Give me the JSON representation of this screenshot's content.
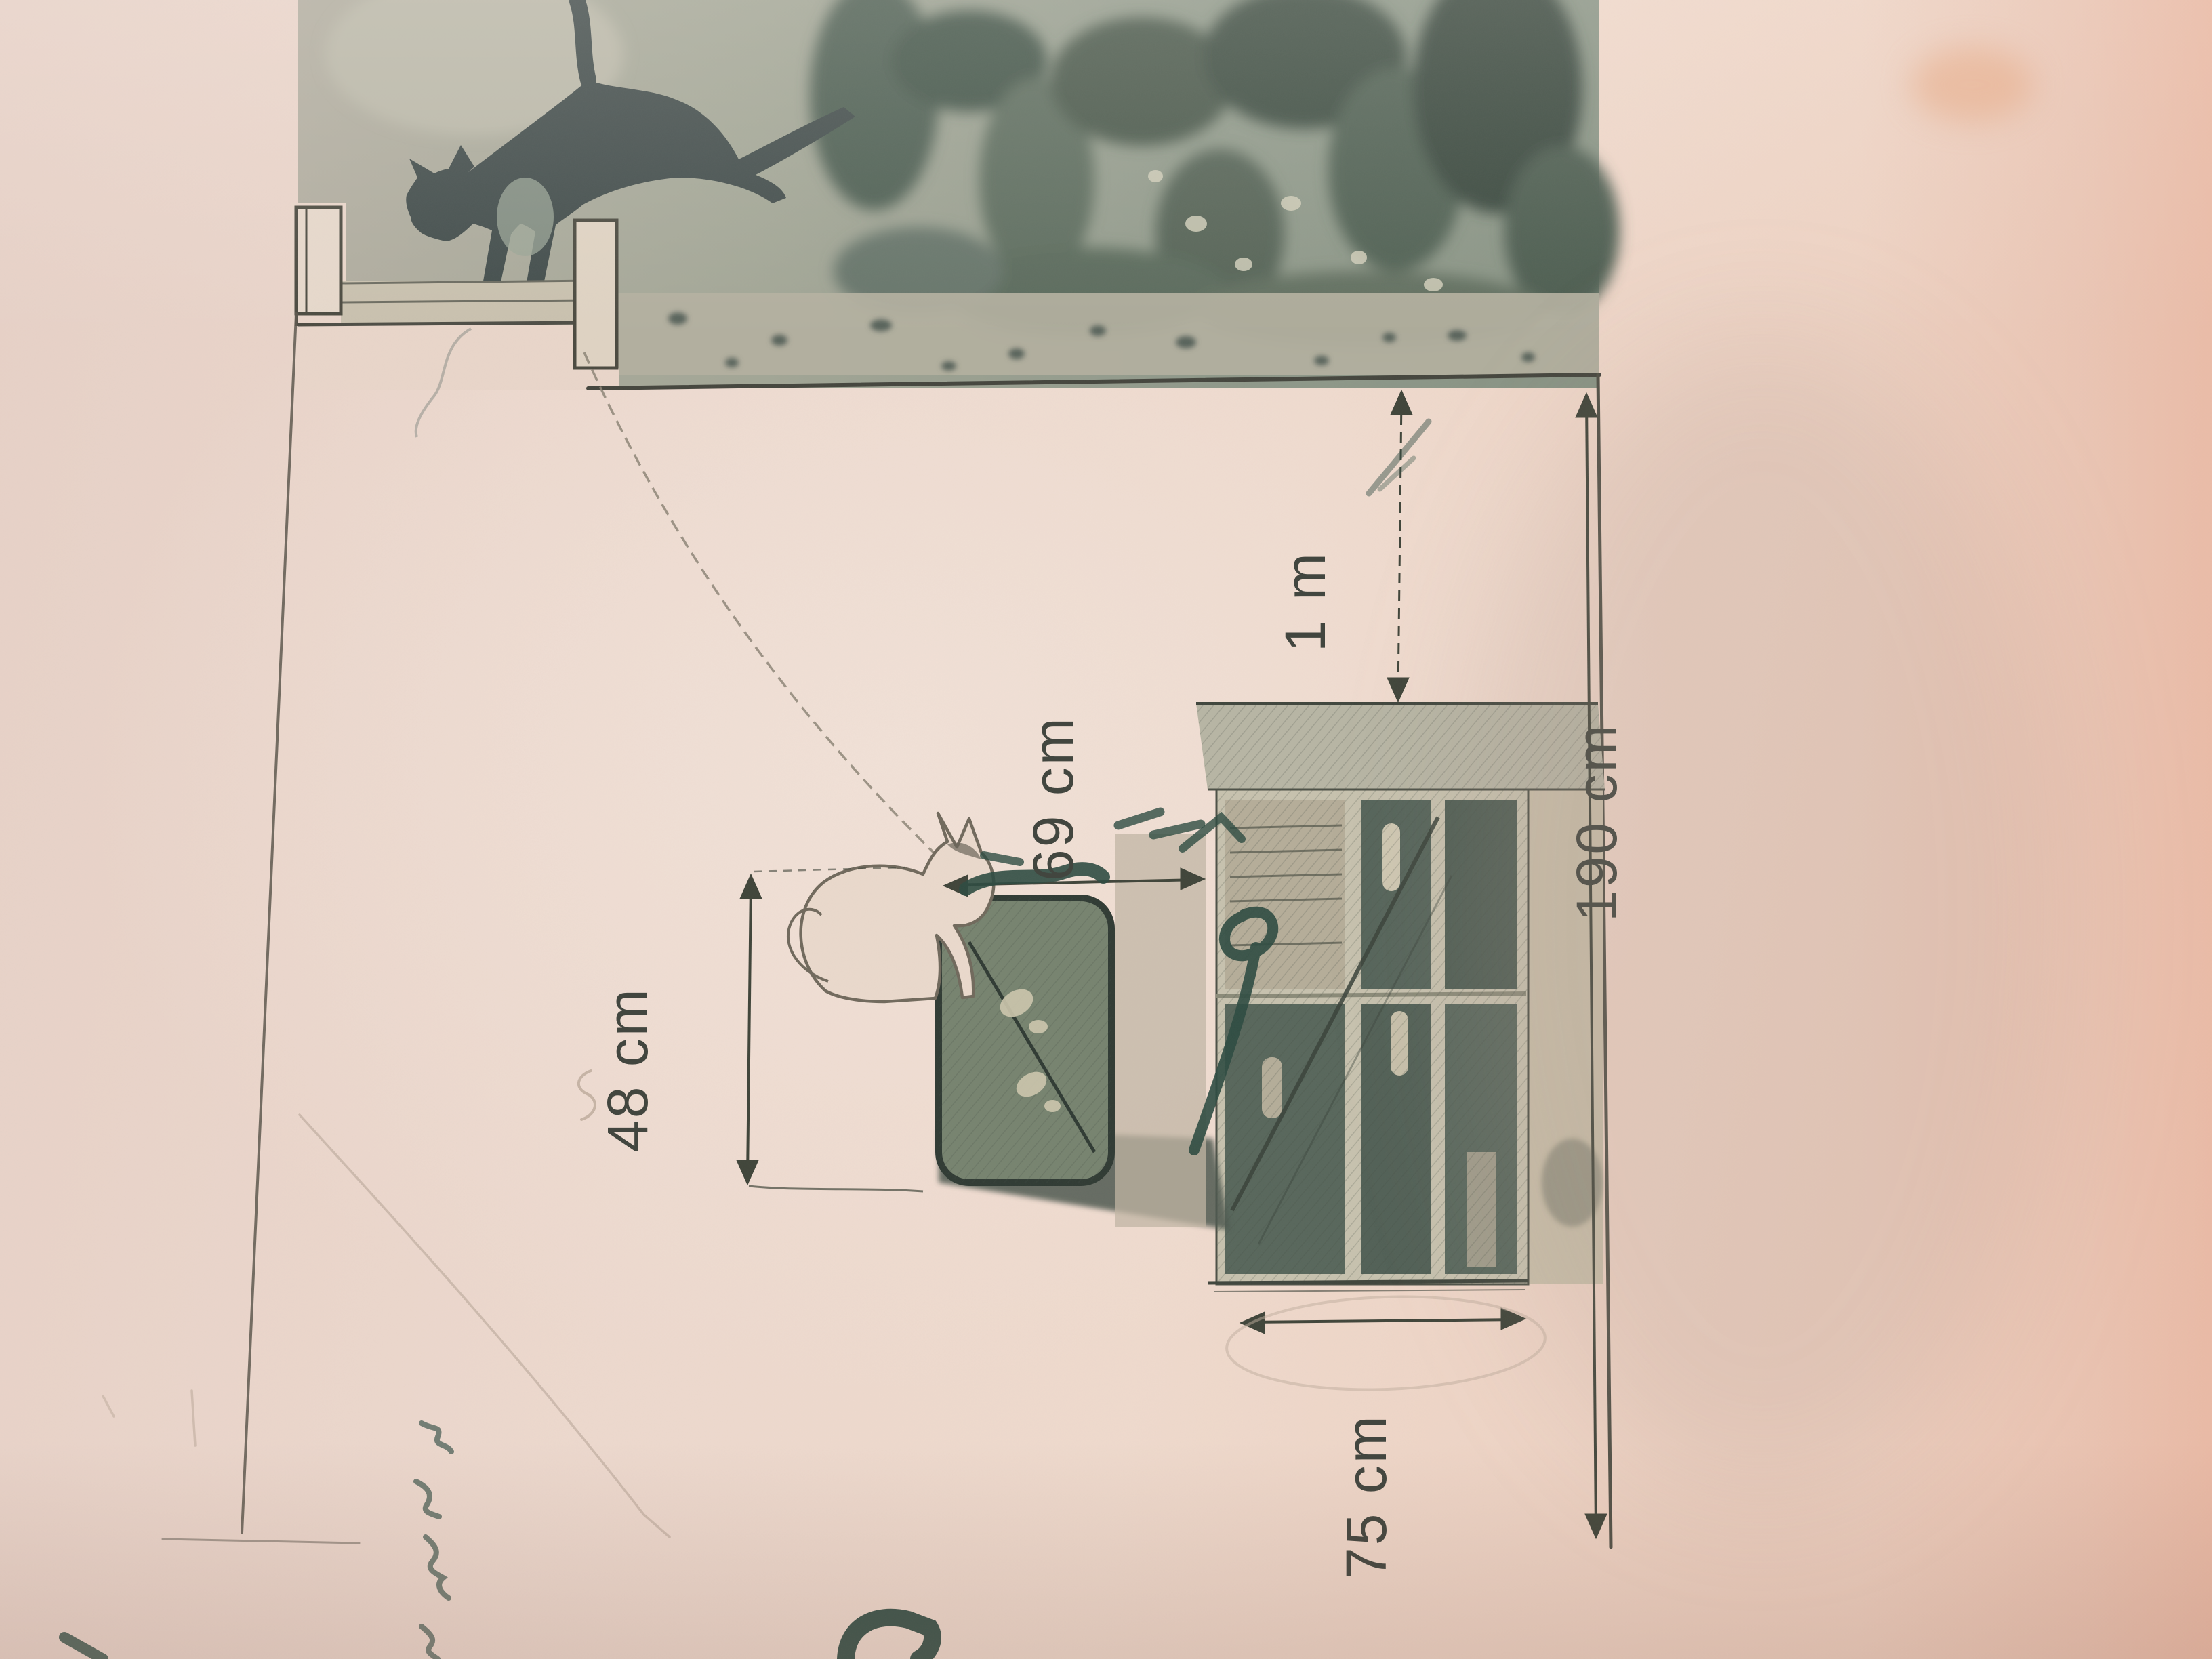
{
  "question": {
    "line1": "téléviseur, et qu",
    "line2": "hauteur se trouve la fenêtre ?"
  },
  "labels": {
    "d48": "48 cm",
    "d69": "69 cm",
    "d1m": "1 m",
    "d190": "190 cm",
    "d75": "75 cm"
  },
  "colors": {
    "paper": "#e9d4c9",
    "printed_ink": "#3d434b",
    "dimension_ink": "#42463f",
    "pen_annotation": "#2c4a40",
    "photo_background": "#9aa294"
  }
}
